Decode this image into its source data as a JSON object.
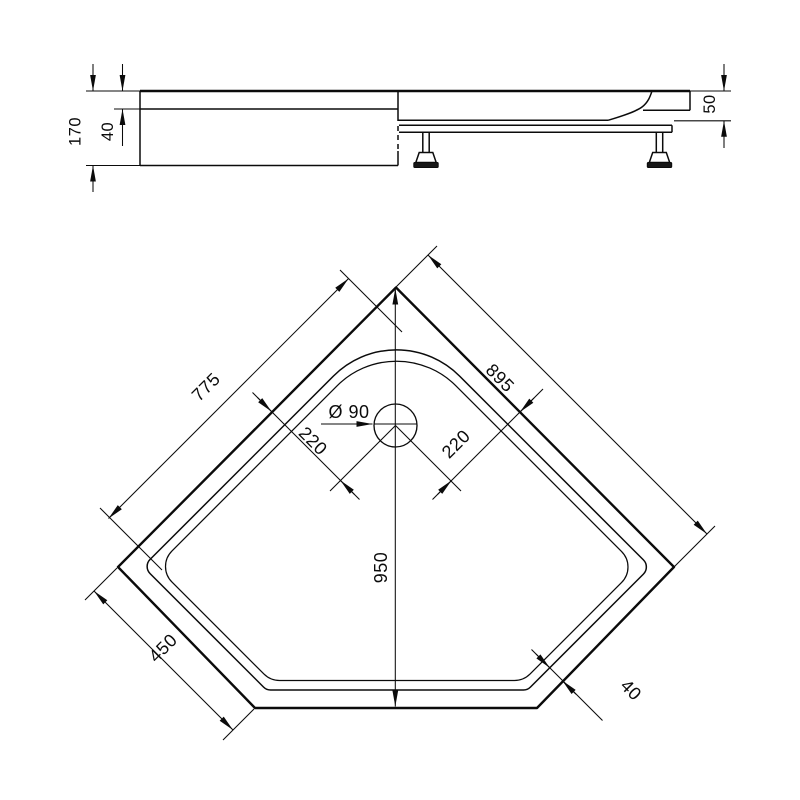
{
  "drawing": {
    "type": "technical-dimension-drawing",
    "subject": "pentagon corner shower tray, side view and plan view",
    "colors": {
      "background": "#ffffff",
      "line": "#0b0b0b"
    },
    "side_view": {
      "labels": {
        "total_height": "170",
        "rim_overlap_height": "40",
        "tray_edge_height": "50"
      }
    },
    "plan_view": {
      "labels": {
        "inner_width_left": "775",
        "wall_edge_right": "895",
        "depth_centerline": "950",
        "front_side_edge": "450",
        "drain_diameter": "Ø 90",
        "drain_offset_left": "220",
        "drain_offset_right": "220",
        "rim_width": "40"
      }
    }
  }
}
